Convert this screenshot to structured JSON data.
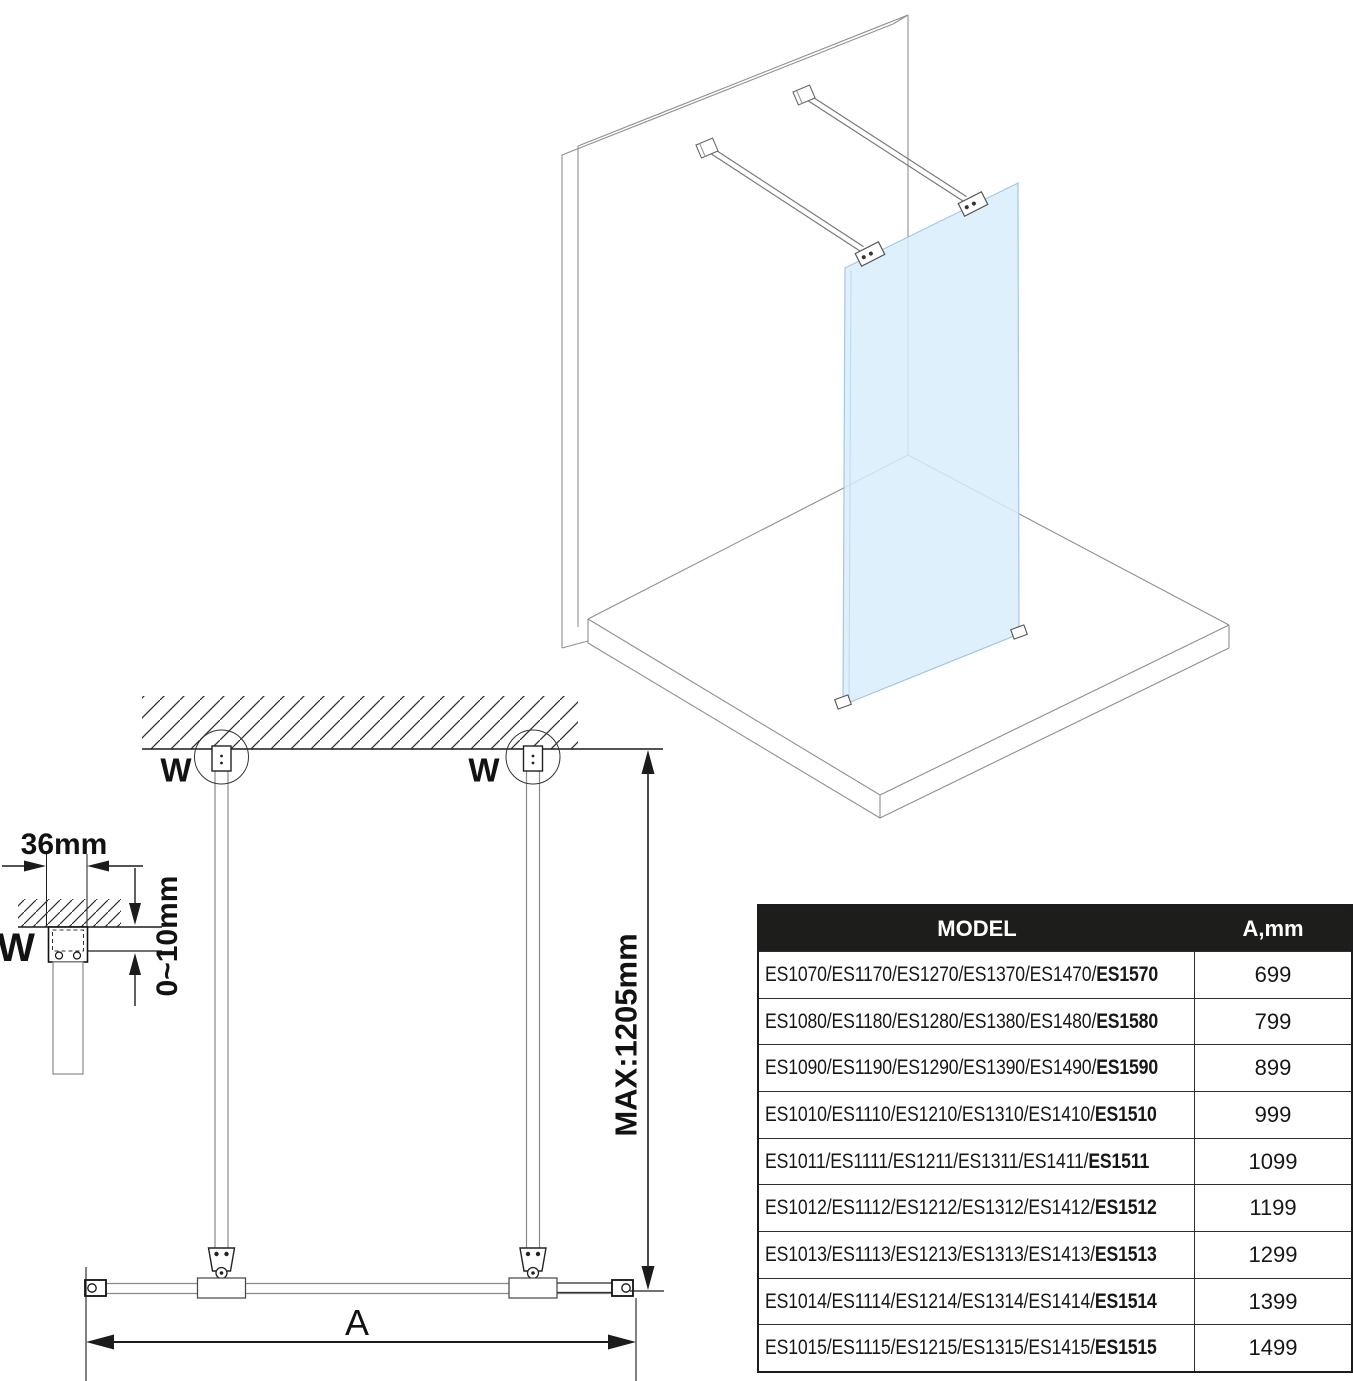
{
  "isometric_view": {
    "glass_color": "#d8edfb"
  },
  "plan_view": {
    "wall_anchor_label_left": "W",
    "wall_anchor_label_right": "W",
    "max_length_label": "MAX:1205mm",
    "width_dim_label": "A"
  },
  "detail_view": {
    "profile_width_label": "36mm",
    "adjust_range_label": "0~10mm",
    "wall_profile_label": "W"
  },
  "table": {
    "headers": {
      "model": "MODEL",
      "dimension": "A,mm"
    },
    "rows": [
      {
        "models": "ES1070/ES1170/ES1270/ES1370/ES1470/",
        "highlight": "ES1570",
        "value": "699"
      },
      {
        "models": "ES1080/ES1180/ES1280/ES1380/ES1480/",
        "highlight": "ES1580",
        "value": "799"
      },
      {
        "models": "ES1090/ES1190/ES1290/ES1390/ES1490/",
        "highlight": "ES1590",
        "value": "899"
      },
      {
        "models": "ES1010/ES1110/ES1210/ES1310/ES1410/",
        "highlight": "ES1510",
        "value": "999"
      },
      {
        "models": "ES1011/ES1111/ES1211/ES1311/ES1411/",
        "highlight": "ES1511",
        "value": "1099"
      },
      {
        "models": "ES1012/ES1112/ES1212/ES1312/ES1412/",
        "highlight": "ES1512",
        "value": "1199"
      },
      {
        "models": "ES1013/ES1113/ES1213/ES1313/ES1413/",
        "highlight": "ES1513",
        "value": "1299"
      },
      {
        "models": "ES1014/ES1114/ES1214/ES1314/ES1414/",
        "highlight": "ES1514",
        "value": "1399"
      },
      {
        "models": "ES1015/ES1115/ES1215/ES1315/ES1415/",
        "highlight": "ES1515",
        "value": "1499"
      }
    ]
  }
}
